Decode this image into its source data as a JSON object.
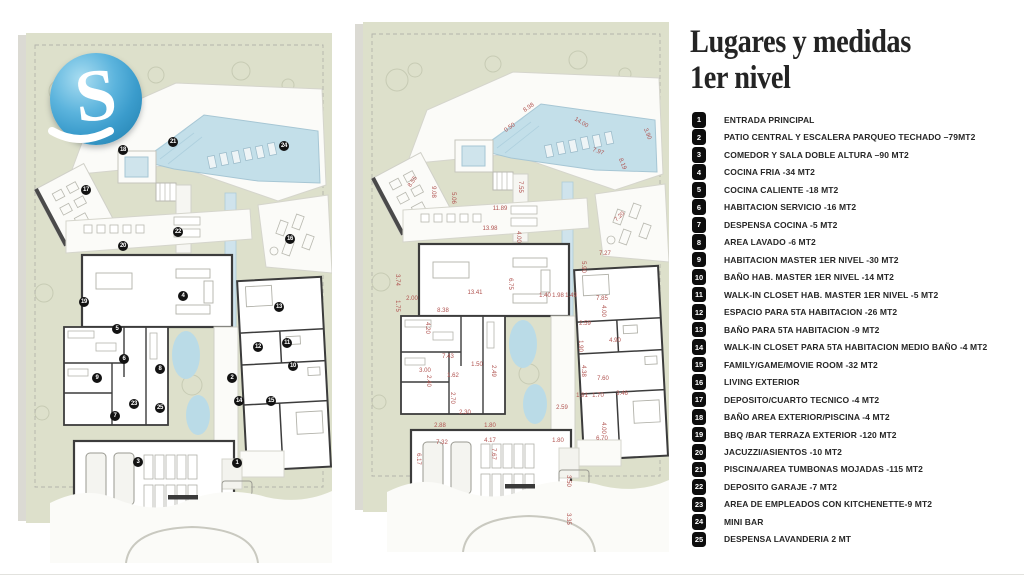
{
  "title": {
    "line1": "Lugares y medidas",
    "line2": "1er nivel"
  },
  "logo": {
    "letter": "S"
  },
  "colors": {
    "site_green": "#dde0cb",
    "pool_blue": "#c3dfe9",
    "wall_dark": "#3c3c3c",
    "dimension_red": "#b0524f",
    "marker_black": "#121212"
  },
  "legend": {
    "items": [
      {
        "num": "1",
        "label": "ENTRADA PRINCIPAL"
      },
      {
        "num": "2",
        "label": "PATIO CENTRAL Y ESCALERA PARQUEO TECHADO –79MT2"
      },
      {
        "num": "3",
        "label": "COMEDOR Y SALA DOBLE ALTURA –90 MT2"
      },
      {
        "num": "4",
        "label": "COCINA FRIA -34 MT2"
      },
      {
        "num": "5",
        "label": "COCINA CALIENTE -18 MT2"
      },
      {
        "num": "6",
        "label": "HABITACION SERVICIO -16 MT2"
      },
      {
        "num": "7",
        "label": "DESPENSA COCINA -5 MT2"
      },
      {
        "num": "8",
        "label": "AREA LAVADO -6 MT2"
      },
      {
        "num": "9",
        "label": "HABITACION MASTER 1ER NIVEL -30 MT2"
      },
      {
        "num": "10",
        "label": "BAÑO HAB. MASTER 1ER NIVEL -14 MT2"
      },
      {
        "num": "11",
        "label": "WALK-IN CLOSET HAB. MASTER 1ER NIVEL -5 MT2"
      },
      {
        "num": "12",
        "label": "ESPACIO PARA 5TA HABITACION -26 MT2"
      },
      {
        "num": "13",
        "label": "BAÑO PARA 5TA HABITACION -9 MT2"
      },
      {
        "num": "14",
        "label": "WALK-IN CLOSET PARA 5TA HABITACION MEDIO BAÑO -4 MT2"
      },
      {
        "num": "15",
        "label": "FAMILY/GAME/MOVIE ROOM -32 MT2"
      },
      {
        "num": "16",
        "label": "LIVING EXTERIOR"
      },
      {
        "num": "17",
        "label": "DEPOSITO/CUARTO TECNICO -4 MT2"
      },
      {
        "num": "18",
        "label": "BAÑO AREA EXTERIOR/PISCINA -4 MT2"
      },
      {
        "num": "19",
        "label": "BBQ /BAR TERRAZA EXTERIOR -120 MT2"
      },
      {
        "num": "20",
        "label": "JACUZZI/ASIENTOS -10 MT2"
      },
      {
        "num": "21",
        "label": "PISCINA/AREA TUMBONAS MOJADAS -115 MT2"
      },
      {
        "num": "22",
        "label": "DEPOSITO GARAJE -7 MT2"
      },
      {
        "num": "23",
        "label": "AREA DE EMPLEADOS CON KITCHENETTE-9 MT2"
      },
      {
        "num": "24",
        "label": "MINI BAR"
      },
      {
        "num": "25",
        "label": "DESPENSA LAVANDERIA 2 MT"
      }
    ]
  },
  "plans": {
    "left": {
      "markers": [
        {
          "n": "1",
          "x": 211,
          "y": 430
        },
        {
          "n": "2",
          "x": 206,
          "y": 345
        },
        {
          "n": "3",
          "x": 112,
          "y": 429
        },
        {
          "n": "4",
          "x": 157,
          "y": 263
        },
        {
          "n": "5",
          "x": 91,
          "y": 296
        },
        {
          "n": "6",
          "x": 98,
          "y": 326
        },
        {
          "n": "7",
          "x": 89,
          "y": 383
        },
        {
          "n": "8",
          "x": 134,
          "y": 336
        },
        {
          "n": "9",
          "x": 71,
          "y": 345
        },
        {
          "n": "10",
          "x": 267,
          "y": 333
        },
        {
          "n": "11",
          "x": 261,
          "y": 310
        },
        {
          "n": "12",
          "x": 232,
          "y": 314
        },
        {
          "n": "13",
          "x": 253,
          "y": 274
        },
        {
          "n": "14",
          "x": 213,
          "y": 368
        },
        {
          "n": "15",
          "x": 245,
          "y": 368
        },
        {
          "n": "16",
          "x": 264,
          "y": 206
        },
        {
          "n": "17",
          "x": 60,
          "y": 157
        },
        {
          "n": "18",
          "x": 97,
          "y": 117
        },
        {
          "n": "19",
          "x": 58,
          "y": 269
        },
        {
          "n": "20",
          "x": 97,
          "y": 213
        },
        {
          "n": "21",
          "x": 147,
          "y": 109
        },
        {
          "n": "22",
          "x": 152,
          "y": 199
        },
        {
          "n": "23",
          "x": 108,
          "y": 371
        },
        {
          "n": "24",
          "x": 258,
          "y": 113
        },
        {
          "n": "25",
          "x": 134,
          "y": 375
        }
      ]
    },
    "right": {
      "dimensions": [
        {
          "v": "8.98",
          "x": 166,
          "y": 86,
          "r": -35
        },
        {
          "v": "0.50",
          "x": 147,
          "y": 106,
          "r": -35
        },
        {
          "v": "14.00",
          "x": 218,
          "y": 101,
          "r": 32
        },
        {
          "v": "3.90",
          "x": 284,
          "y": 112,
          "r": 68
        },
        {
          "v": "7.97",
          "x": 235,
          "y": 130,
          "r": 20
        },
        {
          "v": "8.19",
          "x": 259,
          "y": 142,
          "r": 68
        },
        {
          "v": "8.55",
          "x": 50,
          "y": 160,
          "r": -55
        },
        {
          "v": "9.08",
          "x": 70,
          "y": 170,
          "r": 90
        },
        {
          "v": "5.06",
          "x": 90,
          "y": 176,
          "r": 90
        },
        {
          "v": "7.55",
          "x": 157,
          "y": 165,
          "r": 90
        },
        {
          "v": "11.89",
          "x": 137,
          "y": 187,
          "r": 0
        },
        {
          "v": "13.98",
          "x": 127,
          "y": 207,
          "r": 0
        },
        {
          "v": "4.00",
          "x": 155,
          "y": 215,
          "r": 90
        },
        {
          "v": "7.20",
          "x": 257,
          "y": 195,
          "r": -42
        },
        {
          "v": "7.27",
          "x": 242,
          "y": 232,
          "r": 0
        },
        {
          "v": "5.90",
          "x": 220,
          "y": 245,
          "r": 90
        },
        {
          "v": "3.74",
          "x": 34,
          "y": 258,
          "r": 90
        },
        {
          "v": "6.75",
          "x": 147,
          "y": 262,
          "r": 90
        },
        {
          "v": "13.41",
          "x": 112,
          "y": 271,
          "r": 0
        },
        {
          "v": "2.00",
          "x": 49,
          "y": 277,
          "r": 0
        },
        {
          "v": "1.75",
          "x": 34,
          "y": 284,
          "r": 90
        },
        {
          "v": "8.38",
          "x": 80,
          "y": 289,
          "r": 0
        },
        {
          "v": "1.40",
          "x": 182,
          "y": 274,
          "r": 0
        },
        {
          "v": "1.98",
          "x": 195,
          "y": 274,
          "r": 0
        },
        {
          "v": "1.49",
          "x": 208,
          "y": 274,
          "r": 0
        },
        {
          "v": "7.85",
          "x": 239,
          "y": 277,
          "r": 0
        },
        {
          "v": "4.00",
          "x": 240,
          "y": 289,
          "r": 90
        },
        {
          "v": "2.59",
          "x": 222,
          "y": 302,
          "r": 0
        },
        {
          "v": "4.20",
          "x": 64,
          "y": 306,
          "r": 90
        },
        {
          "v": "4.90",
          "x": 252,
          "y": 319,
          "r": 0
        },
        {
          "v": "1.90",
          "x": 217,
          "y": 324,
          "r": 90
        },
        {
          "v": "7.43",
          "x": 85,
          "y": 335,
          "r": 0
        },
        {
          "v": "1.50",
          "x": 114,
          "y": 343,
          "r": 0
        },
        {
          "v": "2.49",
          "x": 130,
          "y": 349,
          "r": 90
        },
        {
          "v": "3.00",
          "x": 62,
          "y": 349,
          "r": 0
        },
        {
          "v": "1.62",
          "x": 90,
          "y": 354,
          "r": 0
        },
        {
          "v": "2.40",
          "x": 65,
          "y": 359,
          "r": 90
        },
        {
          "v": "7.60",
          "x": 240,
          "y": 357,
          "r": 0
        },
        {
          "v": "4.38",
          "x": 220,
          "y": 349,
          "r": 90
        },
        {
          "v": "2.70",
          "x": 89,
          "y": 376,
          "r": 90
        },
        {
          "v": "1.91",
          "x": 219,
          "y": 374,
          "r": 0
        },
        {
          "v": "1.70",
          "x": 235,
          "y": 374,
          "r": 0
        },
        {
          "v": "3.46",
          "x": 259,
          "y": 372,
          "r": 0
        },
        {
          "v": "2.30",
          "x": 102,
          "y": 391,
          "r": 0
        },
        {
          "v": "2.59",
          "x": 199,
          "y": 386,
          "r": 0
        },
        {
          "v": "2.88",
          "x": 77,
          "y": 404,
          "r": 0
        },
        {
          "v": "1.80",
          "x": 127,
          "y": 404,
          "r": 0
        },
        {
          "v": "4.00",
          "x": 240,
          "y": 406,
          "r": 90
        },
        {
          "v": "6.70",
          "x": 239,
          "y": 417,
          "r": 0
        },
        {
          "v": "7.32",
          "x": 79,
          "y": 421,
          "r": 0
        },
        {
          "v": "4.17",
          "x": 127,
          "y": 419,
          "r": 0
        },
        {
          "v": "6.17",
          "x": 55,
          "y": 437,
          "r": 90
        },
        {
          "v": "7.67",
          "x": 130,
          "y": 432,
          "r": 90
        },
        {
          "v": "1.80",
          "x": 195,
          "y": 419,
          "r": 0
        },
        {
          "v": "3.50",
          "x": 205,
          "y": 459,
          "r": 90
        },
        {
          "v": "3.35",
          "x": 205,
          "y": 497,
          "r": 90
        }
      ]
    }
  }
}
